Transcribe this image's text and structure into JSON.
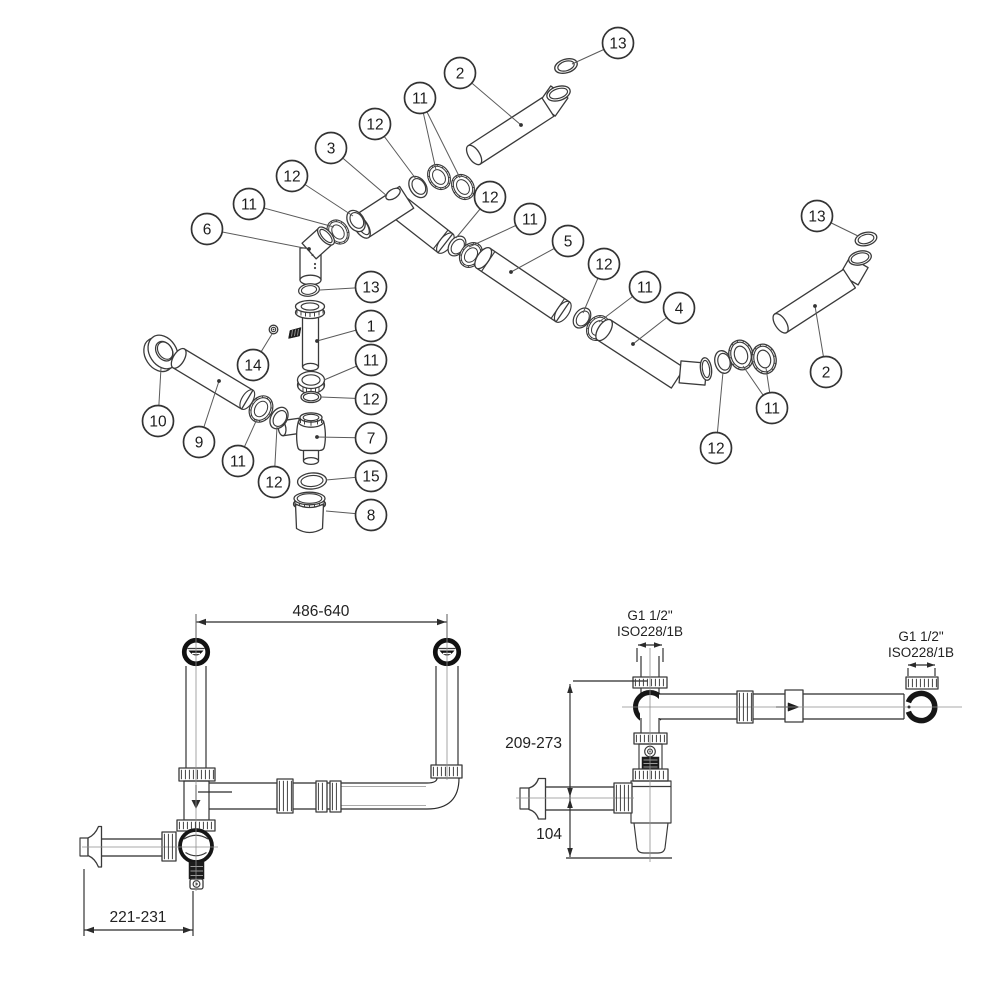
{
  "exploded": {
    "callouts": [
      {
        "n": "13",
        "cx": 618,
        "cy": 43,
        "leaders": [
          [
            572,
            64
          ]
        ],
        "dot": false
      },
      {
        "n": "2",
        "cx": 460,
        "cy": 73,
        "leaders": [
          [
            521,
            125
          ]
        ],
        "dot": true
      },
      {
        "n": "11",
        "cx": 420,
        "cy": 98,
        "leaders": [
          [
            436,
            170
          ],
          [
            460,
            178
          ]
        ],
        "dot": false
      },
      {
        "n": "12",
        "cx": 375,
        "cy": 124,
        "leaders": [
          [
            416,
            179
          ]
        ],
        "dot": false
      },
      {
        "n": "3",
        "cx": 331,
        "cy": 148,
        "leaders": [
          [
            387,
            196
          ]
        ],
        "dot": false
      },
      {
        "n": "12",
        "cx": 292,
        "cy": 176,
        "leaders": [
          [
            353,
            216
          ]
        ],
        "dot": false
      },
      {
        "n": "11",
        "cx": 249,
        "cy": 204,
        "leaders": [
          [
            334,
            227
          ]
        ],
        "dot": false
      },
      {
        "n": "6",
        "cx": 207,
        "cy": 229,
        "leaders": [
          [
            309,
            249
          ]
        ],
        "dot": true
      },
      {
        "n": "12",
        "cx": 490,
        "cy": 197,
        "leaders": [
          [
            456,
            238
          ]
        ],
        "dot": false
      },
      {
        "n": "11",
        "cx": 530,
        "cy": 219,
        "leaders": [
          [
            469,
            247
          ]
        ],
        "dot": false
      },
      {
        "n": "5",
        "cx": 568,
        "cy": 241,
        "leaders": [
          [
            511,
            272
          ]
        ],
        "dot": true
      },
      {
        "n": "12",
        "cx": 604,
        "cy": 264,
        "leaders": [
          [
            583,
            313
          ]
        ],
        "dot": false
      },
      {
        "n": "11",
        "cx": 645,
        "cy": 287,
        "leaders": [
          [
            599,
            322
          ]
        ],
        "dot": false
      },
      {
        "n": "4",
        "cx": 679,
        "cy": 308,
        "leaders": [
          [
            633,
            344
          ]
        ],
        "dot": true
      },
      {
        "n": "13",
        "cx": 817,
        "cy": 216,
        "leaders": [
          [
            858,
            236
          ]
        ],
        "dot": false
      },
      {
        "n": "2",
        "cx": 826,
        "cy": 372,
        "leaders": [
          [
            815,
            306
          ]
        ],
        "dot": true
      },
      {
        "n": "11",
        "cx": 772,
        "cy": 408,
        "leaders": [
          [
            743,
            366
          ],
          [
            766,
            368
          ]
        ],
        "dot": false
      },
      {
        "n": "12",
        "cx": 716,
        "cy": 448,
        "leaders": [
          [
            723,
            372
          ]
        ],
        "dot": false
      },
      {
        "n": "13",
        "cx": 371,
        "cy": 287,
        "leaders": [
          [
            320,
            290
          ]
        ],
        "dot": false
      },
      {
        "n": "1",
        "cx": 371,
        "cy": 326,
        "leaders": [
          [
            317,
            341
          ]
        ],
        "dot": true
      },
      {
        "n": "14",
        "cx": 253,
        "cy": 365,
        "leaders": [
          [
            272,
            334
          ]
        ],
        "dot": false
      },
      {
        "n": "11",
        "cx": 371,
        "cy": 360,
        "leaders": [
          [
            324,
            380
          ]
        ],
        "dot": false
      },
      {
        "n": "12",
        "cx": 371,
        "cy": 399,
        "leaders": [
          [
            321,
            397
          ]
        ],
        "dot": false
      },
      {
        "n": "7",
        "cx": 371,
        "cy": 438,
        "leaders": [
          [
            317,
            437
          ]
        ],
        "dot": true
      },
      {
        "n": "15",
        "cx": 371,
        "cy": 476,
        "leaders": [
          [
            326,
            480
          ]
        ],
        "dot": false
      },
      {
        "n": "8",
        "cx": 371,
        "cy": 515,
        "leaders": [
          [
            326,
            511
          ]
        ],
        "dot": false
      },
      {
        "n": "10",
        "cx": 158,
        "cy": 421,
        "leaders": [
          [
            161,
            368
          ]
        ],
        "dot": false
      },
      {
        "n": "9",
        "cx": 199,
        "cy": 442,
        "leaders": [
          [
            219,
            381
          ]
        ],
        "dot": true
      },
      {
        "n": "11",
        "cx": 238,
        "cy": 461,
        "leaders": [
          [
            257,
            419
          ]
        ],
        "dot": false
      },
      {
        "n": "12",
        "cx": 274,
        "cy": 482,
        "leaders": [
          [
            277,
            427
          ]
        ],
        "dot": false
      }
    ]
  },
  "front_view": {
    "dim_width": "486-640",
    "dim_offset": "221-231"
  },
  "side_view": {
    "dim_height": "209-273",
    "dim_bottom": "104",
    "thread_top": "G1 1/2\"",
    "thread_top_iso": "ISO228/1B",
    "thread_right": "G1 1/2\"",
    "thread_right_iso": "ISO228/1B"
  }
}
